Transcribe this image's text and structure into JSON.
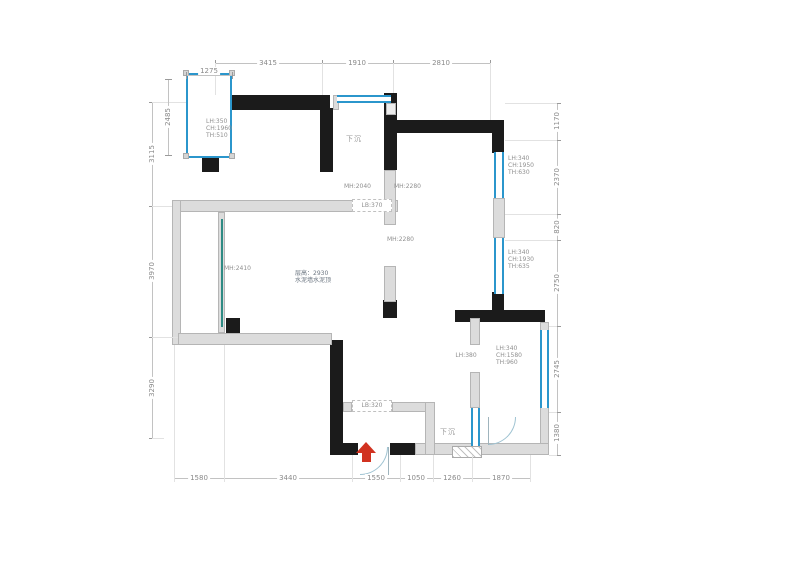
{
  "plan": {
    "room_labels": {
      "sunken_top": "下沉",
      "sunken_bottom": "下沉",
      "ceiling_line1": "层高：2930",
      "ceiling_line2": "水泥墙水泥顶"
    },
    "annotations": {
      "win_tl": [
        "LH:350",
        "CH:1960",
        "TH:510"
      ],
      "win_r1": [
        "LH:340",
        "CH:1950",
        "TH:630"
      ],
      "win_r2": [
        "LH:340",
        "CH:1930",
        "TH:635"
      ],
      "win_r3": [
        "LH:340",
        "CH:1580",
        "TH:960"
      ],
      "mh_2040": "MH:2040",
      "mh_2280_a": "MH:2280",
      "mh_2280_b": "MH:2280",
      "mh_2410": "MH:2410",
      "lb_370": "LB:370",
      "lb_320": "LB:320",
      "lh_380": "LH:380"
    },
    "dimensions": {
      "top": [
        "3415",
        "1910",
        "2810"
      ],
      "top_inner": "1275",
      "left": [
        "3115",
        "3970",
        "3290"
      ],
      "left_inner": "2485",
      "right": [
        "1170",
        "2370",
        "820",
        "2750",
        "2745",
        "1380"
      ],
      "bottom": [
        "1580",
        "3440",
        "1550",
        "1050",
        "1260",
        "1870"
      ]
    },
    "colors": {
      "wall": "#1b1b1b",
      "wall_light": "#dcdcdc",
      "window": "#2b96cc",
      "entry_arrow": "#d13220",
      "dim_text": "#8a8a8a"
    }
  }
}
